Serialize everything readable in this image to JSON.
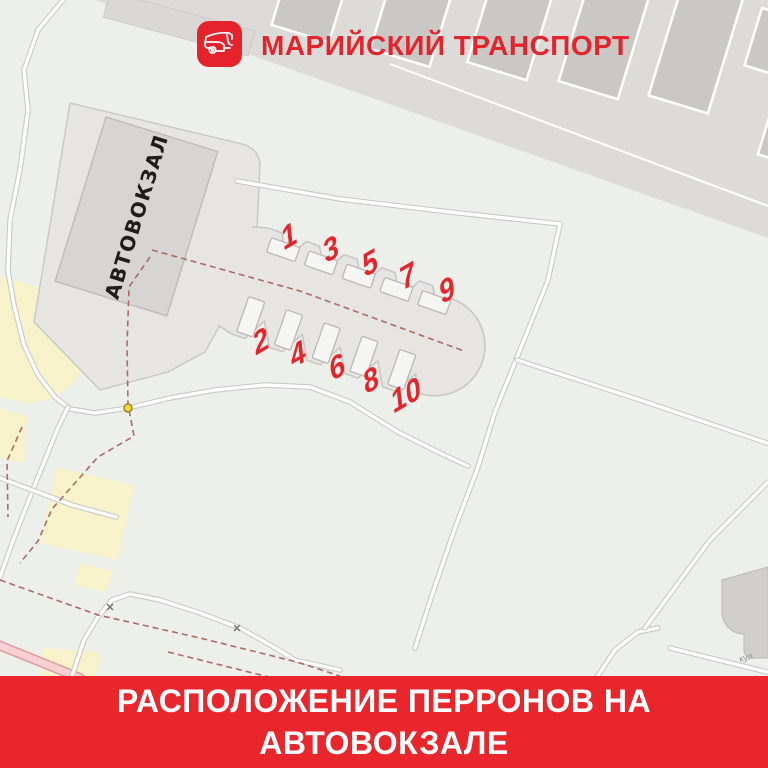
{
  "header": {
    "brand": "МАРИЙСКИЙ ТРАНСПОРТ",
    "logo_icon": "bus-icon"
  },
  "map": {
    "building_label": "АВТОВОКЗАЛ",
    "street_label": "кул",
    "platforms": {
      "odd_row": [
        "1",
        "3",
        "5",
        "7",
        "9"
      ],
      "even_row": [
        "2",
        "4",
        "6",
        "8",
        "10"
      ],
      "items": [
        {
          "label": "1",
          "x": 289,
          "y": 237
        },
        {
          "label": "3",
          "x": 331,
          "y": 250
        },
        {
          "label": "5",
          "x": 370,
          "y": 264
        },
        {
          "label": "7",
          "x": 408,
          "y": 277
        },
        {
          "label": "9",
          "x": 447,
          "y": 291
        },
        {
          "label": "2",
          "x": 261,
          "y": 342
        },
        {
          "label": "4",
          "x": 298,
          "y": 355
        },
        {
          "label": "6",
          "x": 337,
          "y": 368
        },
        {
          "label": "8",
          "x": 371,
          "y": 381
        },
        {
          "label": "10",
          "x": 406,
          "y": 396
        }
      ]
    }
  },
  "banner": {
    "line1": "РАСПОЛОЖЕНИЕ ПЕРРОНОВ НА",
    "line2": "АВТОВОКЗАЛЕ"
  },
  "colors": {
    "banner_red": "#e9262b",
    "brand_red": "#e5232b",
    "number_red": "#e3262b",
    "dash_red": "#ad6a66",
    "map_bg": "#edefeb",
    "plot_gray": "#e6e5e2",
    "building_gray": "#d7d5d3",
    "slab_gray": "#dcdbd8",
    "garage_gray": "#c9c8c5",
    "yellow_area": "#f8f2cb",
    "road_casing": "#c8c7c5",
    "dot_yellow": "#fbd73a",
    "pink_road": "#f6d0d3",
    "br_building": "#d0cfcc",
    "building_text": "#1d1d1d",
    "street_label": "#8f8f8f"
  }
}
